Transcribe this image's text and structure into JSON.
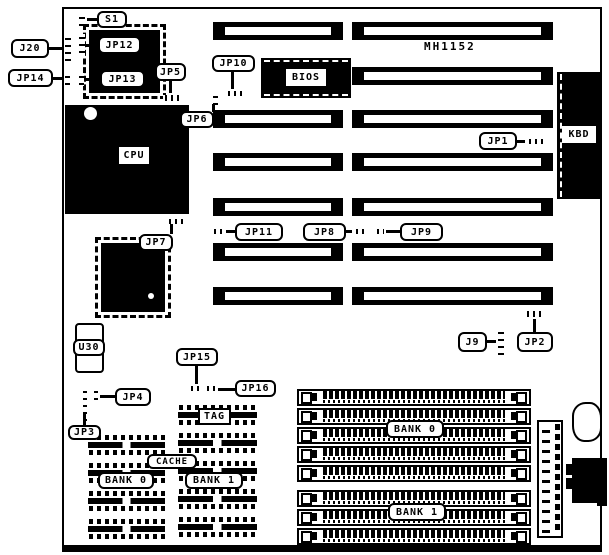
{
  "board": {
    "model": "MH1152"
  },
  "colors": {
    "ink": "#000000",
    "paper": "#ffffff"
  },
  "callouts": {
    "s1": "S1",
    "j20": "J20",
    "jp12": "JP12",
    "jp14": "JP14",
    "jp13": "JP13",
    "jp5": "JP5",
    "jp10": "JP10",
    "jp6": "JP6",
    "jp1": "JP1",
    "jp7": "JP7",
    "jp11": "JP11",
    "jp8": "JP8",
    "jp9": "JP9",
    "j9": "J9",
    "jp2": "JP2",
    "jp15": "JP15",
    "jp16": "JP16",
    "jp4": "JP4",
    "jp3": "JP3",
    "u30": "U30",
    "tag": "TAG",
    "cache": "CACHE",
    "cache_bank0": "BANK 0",
    "cache_bank1": "BANK 1",
    "simm_bank0": "BANK 0",
    "simm_bank1": "BANK 1"
  },
  "components": {
    "cpu": "CPU",
    "bios": "BIOS",
    "kbd": "KBD"
  }
}
